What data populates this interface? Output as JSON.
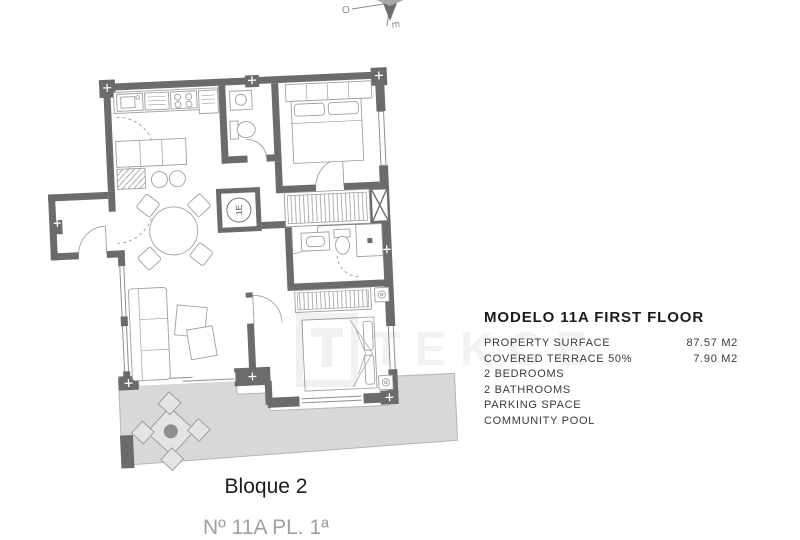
{
  "plan": {
    "compass": {
      "west_label": "O",
      "east_label": "E"
    },
    "elevator_label": "1E",
    "colors": {
      "wall": "#6b6b6b",
      "terrace_fill": "#d8d8d8",
      "terrace_edge": "#b5b5b5",
      "furniture_line": "#9f9f9f"
    }
  },
  "watermark": {
    "text": "TEKCE"
  },
  "info": {
    "title": "MODELO 11A FIRST FLOOR",
    "rows": [
      {
        "label": "PROPERTY SURFACE",
        "value": "87.57 M2"
      },
      {
        "label": "COVERED TERRACE 50%",
        "value": "7.90 M2"
      },
      {
        "label": "2 BEDROOMS",
        "value": ""
      },
      {
        "label": "2 BATHROOMS",
        "value": ""
      },
      {
        "label": "PARKING SPACE",
        "value": ""
      },
      {
        "label": "COMMUNITY POOL",
        "value": ""
      }
    ]
  },
  "footer": {
    "block_label": "Bloque 2",
    "unit_label": "Nº 11A PL. 1ª"
  }
}
